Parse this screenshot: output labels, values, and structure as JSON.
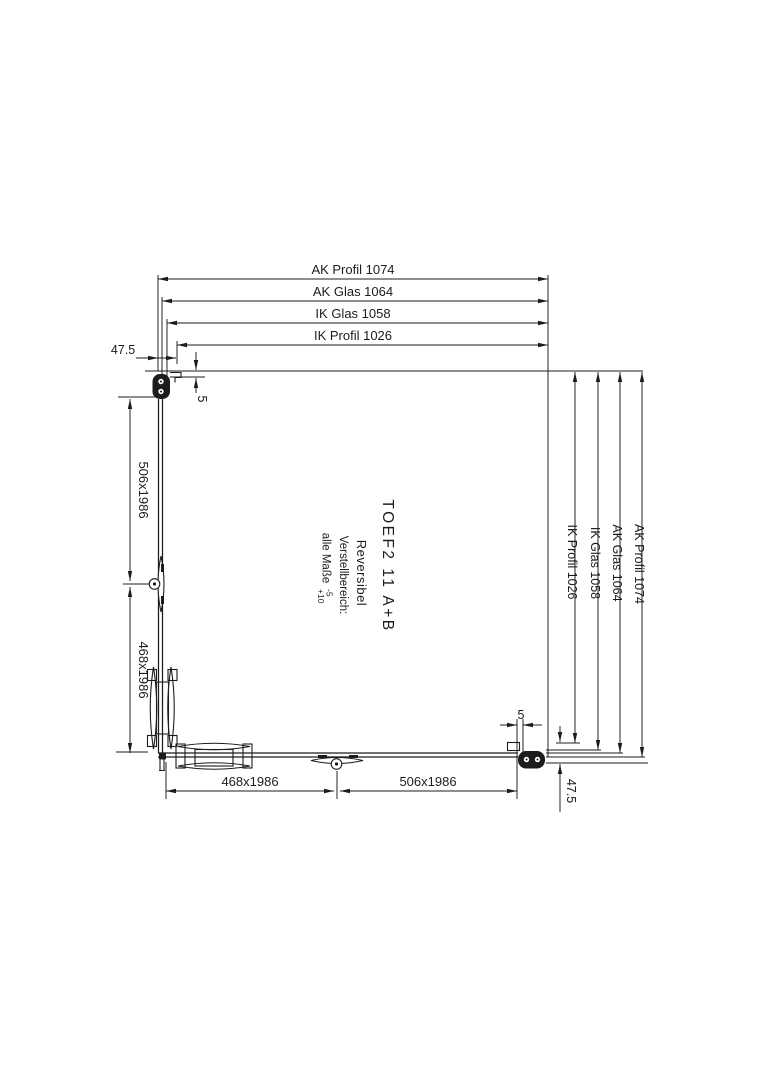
{
  "colors": {
    "line": "#1c1c1c",
    "background": "#ffffff"
  },
  "dims_top": [
    "AK Profil 1074",
    "AK Glas 1064",
    "IK Glas 1058",
    "IK Profil 1026"
  ],
  "dims_right": [
    "IK Profil 1026",
    "IK Glas 1058",
    "AK Glas 1064",
    "AK Profil 1074"
  ],
  "dims_left": [
    "506x1986",
    "468x1986"
  ],
  "dims_bottom": [
    "468x1986",
    "506x1986"
  ],
  "offsets": {
    "top_left": "47.5",
    "bottom_right": "47.5"
  },
  "gaps": {
    "top_left": "5",
    "bottom_right": "5"
  },
  "annotation": {
    "model": "TOEF2 11 A+B",
    "variant": "Reversibel",
    "adjustment_heading": "Verstellbereich:",
    "adjustment_text": "alle Maße",
    "tolerance_minus": "-5",
    "tolerance_plus": "+10"
  }
}
